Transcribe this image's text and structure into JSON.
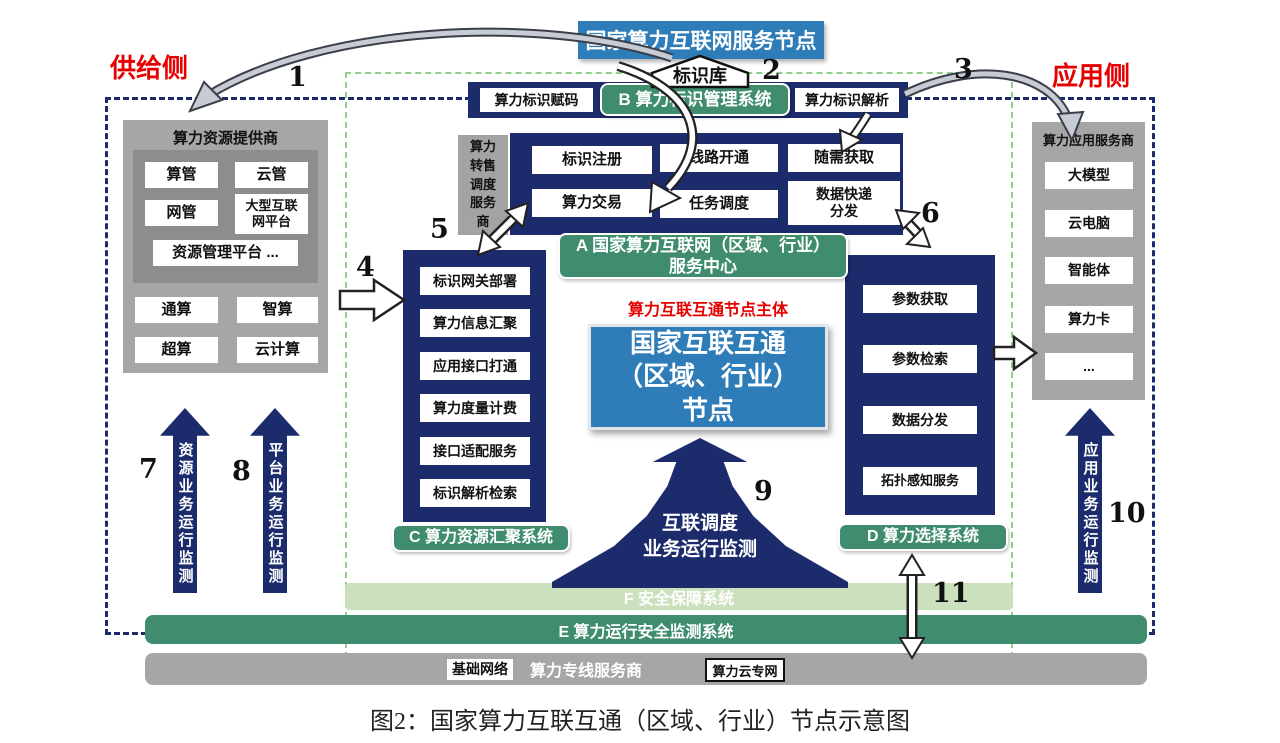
{
  "title_caption": "图2：国家算力互联互通（区域、行业）节点示意图",
  "top_node": {
    "label": "国家算力互联网服务节点",
    "id_library": "标识库"
  },
  "side_labels": {
    "supply": "供给侧",
    "application": "应用侧"
  },
  "numbers": {
    "1": "1",
    "2": "2",
    "3": "3",
    "4": "4",
    "5": "5",
    "6": "6",
    "7": "7",
    "8": "8",
    "9": "9",
    "10": "10",
    "11": "11"
  },
  "supply_panel": {
    "title": "算力资源提供商",
    "platform_items": [
      "算管",
      "云管",
      "网管",
      "大型互联\n网平台",
      "资源管理平台 ..."
    ],
    "compute_items": [
      "通算",
      "智算",
      "超算",
      "云计算"
    ]
  },
  "reseller_box": {
    "label": "算力转售调度服务商"
  },
  "b_system": {
    "encode": "算力标识赋码",
    "label": "B 算力标识管理系统",
    "resolve": "算力标识解析"
  },
  "a_center": {
    "items": [
      "标识注册",
      "线路开通",
      "随需获取",
      "算力交易",
      "任务调度",
      "数据快递\n分发"
    ],
    "label": "A 国家算力互联网（区域、行业）\n服务中心"
  },
  "c_system": {
    "items": [
      "标识网关部署",
      "算力信息汇聚",
      "应用接口打通",
      "算力度量计费",
      "接口适配服务",
      "标识解析检索"
    ],
    "label": "C 算力资源汇聚系统"
  },
  "d_system": {
    "items": [
      "参数获取",
      "参数检索",
      "数据分发",
      "拓扑感知服务"
    ],
    "label": "D 算力选择系统"
  },
  "core_node": {
    "subject_label": "算力互联互通节点主体",
    "node_label": "国家互联互通\n（区域、行业）\n节点"
  },
  "monitor_arrows": {
    "resource": "资源业务运行监测",
    "platform": "平台业务运行监测",
    "application": "应用业务运行监测",
    "interconnect": "互联调度\n业务运行监测"
  },
  "f_bar": {
    "label": "F 安全保障系统"
  },
  "e_bar": {
    "label": "E 算力运行安全监测系统"
  },
  "infra_bar": {
    "base_network": "基础网络",
    "provider": "算力专线服务商",
    "cloud_network": "算力云专网"
  },
  "app_panel": {
    "title": "算力应用服务商",
    "items": [
      "大模型",
      "云电脑",
      "智能体",
      "算力卡",
      "..."
    ]
  },
  "colors": {
    "navy": "#1c2b6b",
    "blue": "#2e7cb8",
    "green": "#3f8d6e",
    "light_green": "#cbe0bc",
    "gray": "#a6a6a6",
    "red": "#e60000"
  }
}
